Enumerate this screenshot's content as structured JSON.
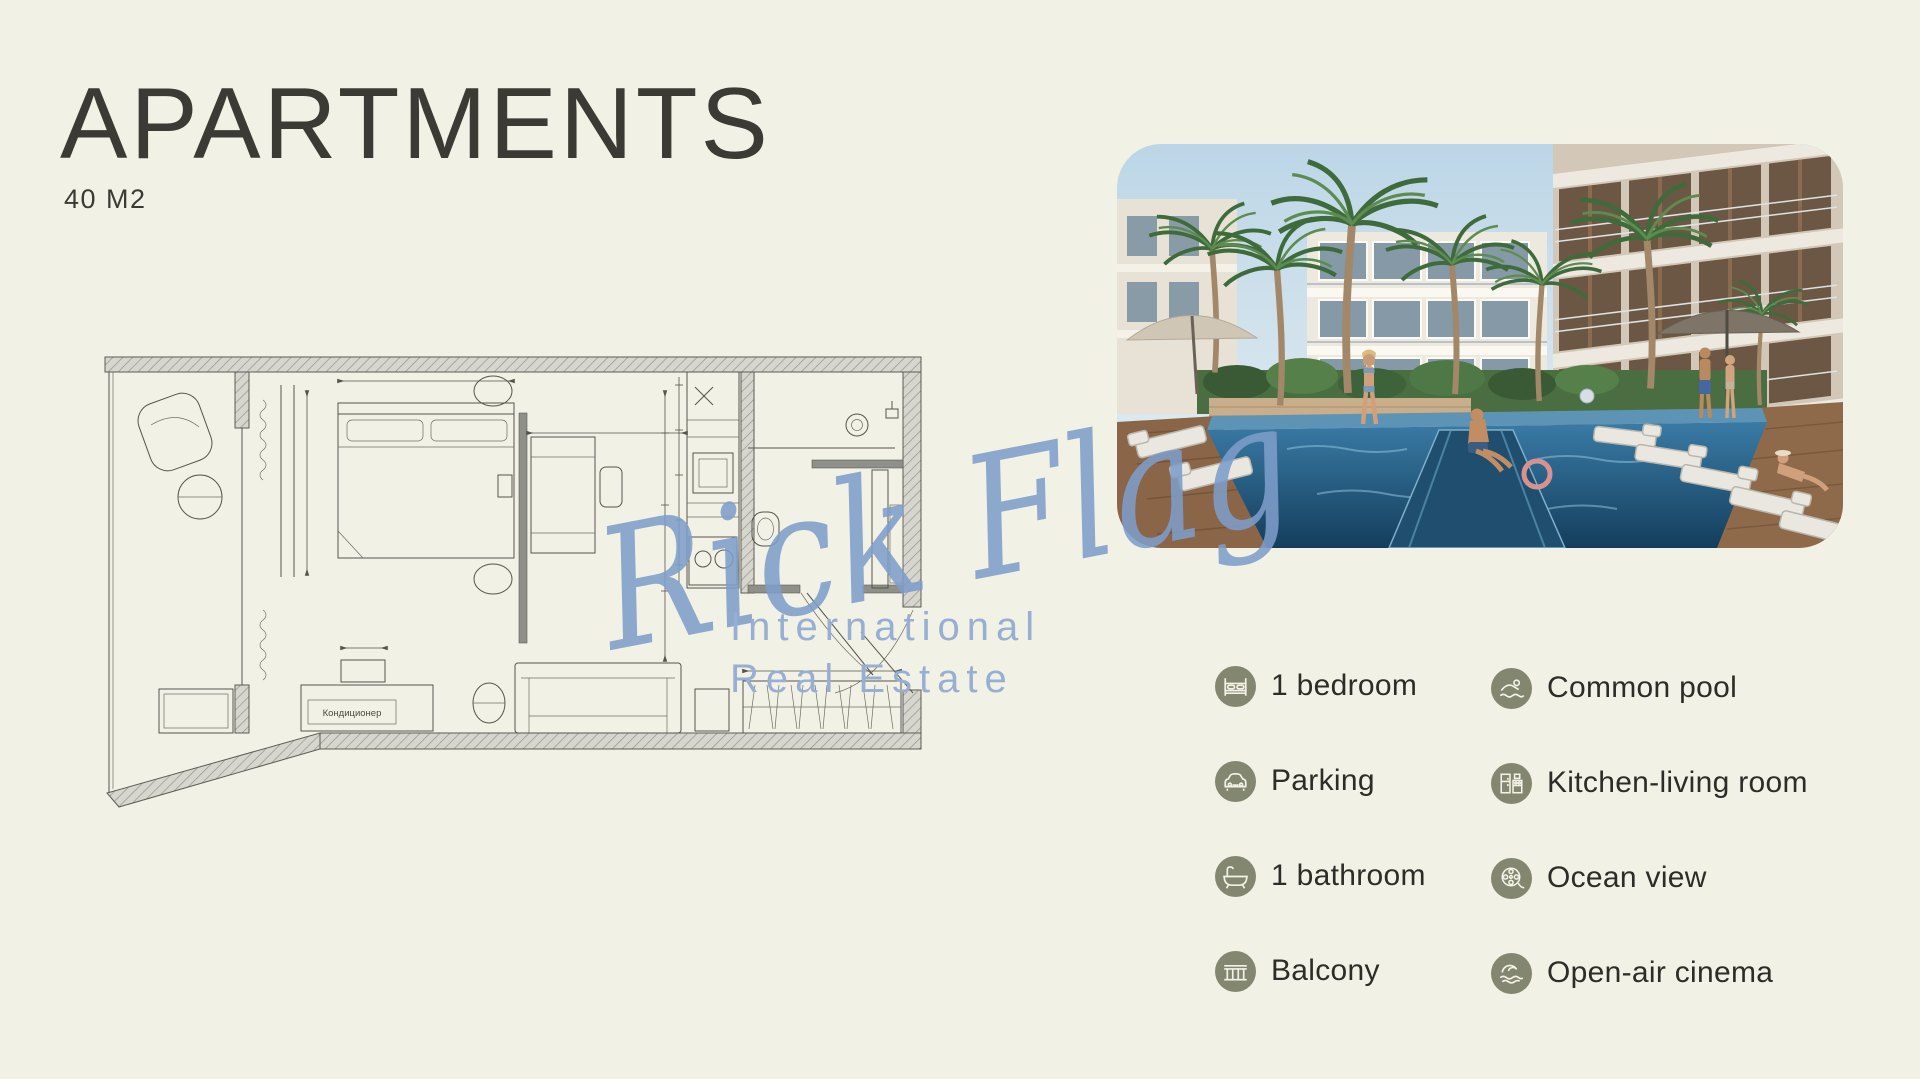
{
  "header": {
    "title": "APARTMENTS",
    "subtitle": "40 M2"
  },
  "watermark": {
    "script": "Rick Flag",
    "line1": "International",
    "line2": "Real Estate",
    "color": "#7D9DC9"
  },
  "floor_plan": {
    "ac_label": "Кондиционер"
  },
  "photo": {
    "description": "resort pool courtyard with palm trees, apartment buildings, sun loungers and people"
  },
  "features": {
    "accent_color": "#84876F",
    "text_color": "#2C2C28",
    "left": [
      {
        "icon": "bed-icon",
        "label": "1 bedroom"
      },
      {
        "icon": "car-icon",
        "label": "Parking"
      },
      {
        "icon": "bathtub-icon",
        "label": "1 bathroom"
      },
      {
        "icon": "balcony-railing-icon",
        "label": "Balcony"
      }
    ],
    "right": [
      {
        "icon": "swimmer-icon",
        "label": "Common pool"
      },
      {
        "icon": "kitchen-icon",
        "label": "Kitchen-living room"
      },
      {
        "icon": "film-reel-icon",
        "label": "Ocean view"
      },
      {
        "icon": "wave-icon",
        "label": "Open-air cinema"
      }
    ]
  }
}
